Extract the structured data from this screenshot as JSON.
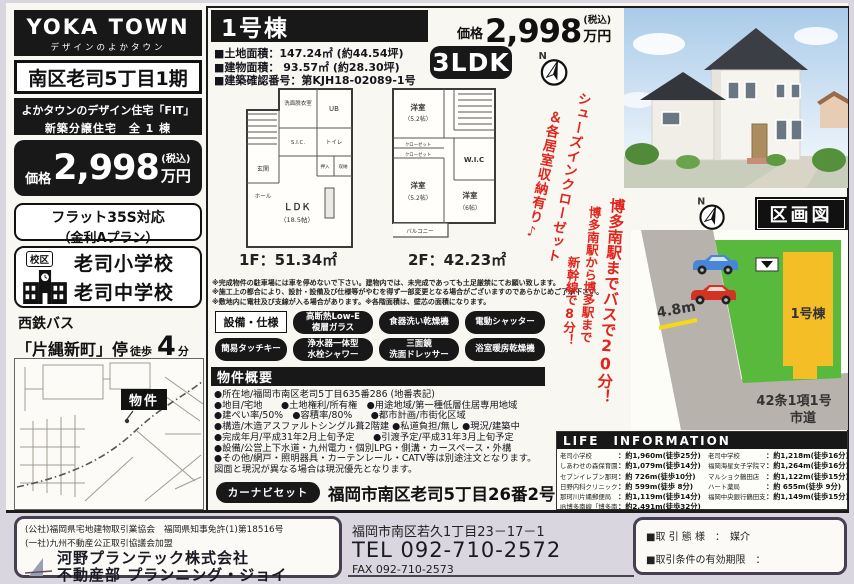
{
  "left": {
    "brand": {
      "title": "YOKA TOWN",
      "subtitle": "デザインのよかタウン"
    },
    "area_title": "南区老司5丁目1期",
    "catch_line1": "よかタウンのデザイン住宅「FIT」",
    "catch_line2": "新築分譲住宅　全 1 棟",
    "price": {
      "label": "価格",
      "value": "2,998",
      "tax": "(税込)",
      "unit": "万円"
    },
    "flat35_line1": "フラット35S対応",
    "flat35_line2": "（金利Aプラン）",
    "school": {
      "badge": "校区",
      "line1": "老司小学校",
      "line2": "老司中学校"
    },
    "bus": {
      "company": "西鉄バス",
      "stop": "「片縄新町」停",
      "walk": "徒歩",
      "minutes": "4",
      "unit": "分"
    },
    "map_marker": "物件"
  },
  "center": {
    "building_title": "1号棟",
    "price": {
      "label": "価格",
      "value": "2,998",
      "tax": "(税込)",
      "unit": "万円"
    },
    "specs": [
      "■土地面積：147.24㎡ (約44.54坪)",
      "■建物面積：  93.57㎡ (約28.30坪)",
      "■建築確認番号：第KJH18-02089-1号"
    ],
    "madori": "3LDK",
    "plan1": {
      "floor_label": "1F：51.34㎡",
      "rooms": {
        "senmen": "洗面脱衣室",
        "ub": "UB",
        "toilet": "トイレ",
        "sic": "S.I.C.",
        "oshiire": "押入",
        "shuno": "収納",
        "genkan": "玄関",
        "hall": "ホール",
        "ldk1": "ＬＤＫ",
        "ldk2": "（18.5帖）"
      }
    },
    "plan2": {
      "floor_label": "2F：42.23㎡",
      "rooms": {
        "y1a": "洋室",
        "y1b": "（5.2帖）",
        "c1": "クローゼット",
        "c2": "クローゼット",
        "wic": "W.I.C",
        "y2a": "洋室",
        "y2b": "（5.2帖）",
        "y3a": "洋室",
        "y3b": "（6帖）",
        "balcony": "バルコニー"
      }
    },
    "red_note_col1": "シューズインクローゼット",
    "red_note_col2": "＆各居室収納有り♪",
    "disclaimer": [
      "※完成物件の駐車場には車を停めないで下さい。建物内では、未完成であっても土足厳禁にてお願い致します。",
      "※施工上の都合により、設計・設備及び仕様等がやむを得ず一部変更となる場合がございますのであらかじめご了承下さい。",
      "※敷地内に電柱及び支線が入る場合があります。※各階面積は、壁芯の面積になります。"
    ],
    "equipment_title": "設備・仕様",
    "equipment": [
      {
        "line1": "高断熱Low-E",
        "line2": "複層ガラス"
      },
      {
        "line1": "食器洗い乾燥機",
        "line2": ""
      },
      {
        "line1": "電動シャッター",
        "line2": ""
      },
      {
        "line1": "簡易タッチキー",
        "line2": ""
      },
      {
        "line1": "浄水器一体型",
        "line2": "水栓シャワー"
      },
      {
        "line1": "三面鏡",
        "line2": "洗面ドレッサー"
      },
      {
        "line1": "浴室暖房乾燥機",
        "line2": ""
      }
    ],
    "overview_title": "物件概要",
    "overview": [
      "●所在地/福岡市南区老司5丁目635番286 (地番表記)",
      "●地目/宅地　　●土地権利/所有権　●用途地域/第一種低層住居専用地域",
      "●建ぺい率/50%　●容積率/80%　　●都市計画/市街化区域",
      "●構造/木造アスファルトシングル葺2階建 ●私道負担/無し ●現況/建築中",
      "●完成年月/平成31年2月上旬予定　　●引渡予定/平成31年3月上旬予定",
      "●設備/公営上下水道・九州電力・個別LPG・側溝・カースペース・外構",
      "●その他/網戸・照明器具・カーテンレール・CATV等は別途注文となります。",
      "図面と現況が異なる場合は現況優先となります。"
    ],
    "navi": {
      "badge": "カーナビセット",
      "address": "福岡市南区老司5丁目26番2号"
    }
  },
  "right": {
    "red_vertical": {
      "col1": "博多南駅までバスで20分！",
      "col2": "博多南駅から博多駅まで",
      "col3": "新幹線で8分！"
    },
    "kukaku": {
      "title": "区画図",
      "lot_label": "1号棟",
      "road_width": "4.8m",
      "road_note1": "42条1項1号",
      "road_note2": "市道"
    },
    "life": {
      "title": "LIFE　INFORMATION",
      "left": [
        {
          "name": "老司小学校",
          "value": "：約1,960m(徒歩25分)"
        },
        {
          "name": "しあわせの森保育園",
          "value": "：約1,079m(徒歩14分)"
        },
        {
          "name": "セブンイレブン那珂川片縄西",
          "value": "：約 726m(徒歩10分)"
        },
        {
          "name": "日野内科クリニック",
          "value": "：約 599m(徒歩 8分)"
        },
        {
          "name": "那珂川片縄郵便局",
          "value": "：約1,119m(徒歩14分)"
        },
        {
          "name": "JR博多南線「博多南」駅",
          "value": "：約2,491m(徒歩32分)"
        }
      ],
      "right": [
        {
          "name": "老司中学校",
          "value": "：約1,218m(徒歩16分)"
        },
        {
          "name": "福岡海星女子学院マリア幼稚園",
          "value": "：約1,264m(徒歩16分)"
        },
        {
          "name": "マルショク鶴田店",
          "value": "：約1,122m(徒歩15分)"
        },
        {
          "name": "ハート薬局",
          "value": "：約 655m(徒歩 9分)"
        },
        {
          "name": "福岡中央銀行鶴田支店",
          "value": "：約1,149m(徒歩15分)"
        }
      ]
    }
  },
  "footer": {
    "license1": "(公社)福岡県宅地建物取引業協会　福岡県知事免許(1)第18516号",
    "license2": "(一社)九州不動産公正取引協議会加盟",
    "company_line1": "河野プランテック株式会社",
    "company_line2": "不動産部 プランニング・ジョイ",
    "office_address": "福岡市南区若久1丁目23－17－1",
    "tel": "TEL 092-710-2572",
    "fax": "FAX 092-710-2573",
    "deal_type": "■取 引 態 様　：　媒介",
    "deal_expiry": "■取引条件の有効期限　："
  },
  "compass_n": "N",
  "colors": {
    "accent_red": "#e0261c",
    "lot_green": "#58b93c",
    "lot_yellow": "#f4be27",
    "road_gray": "#b7b3ac"
  }
}
